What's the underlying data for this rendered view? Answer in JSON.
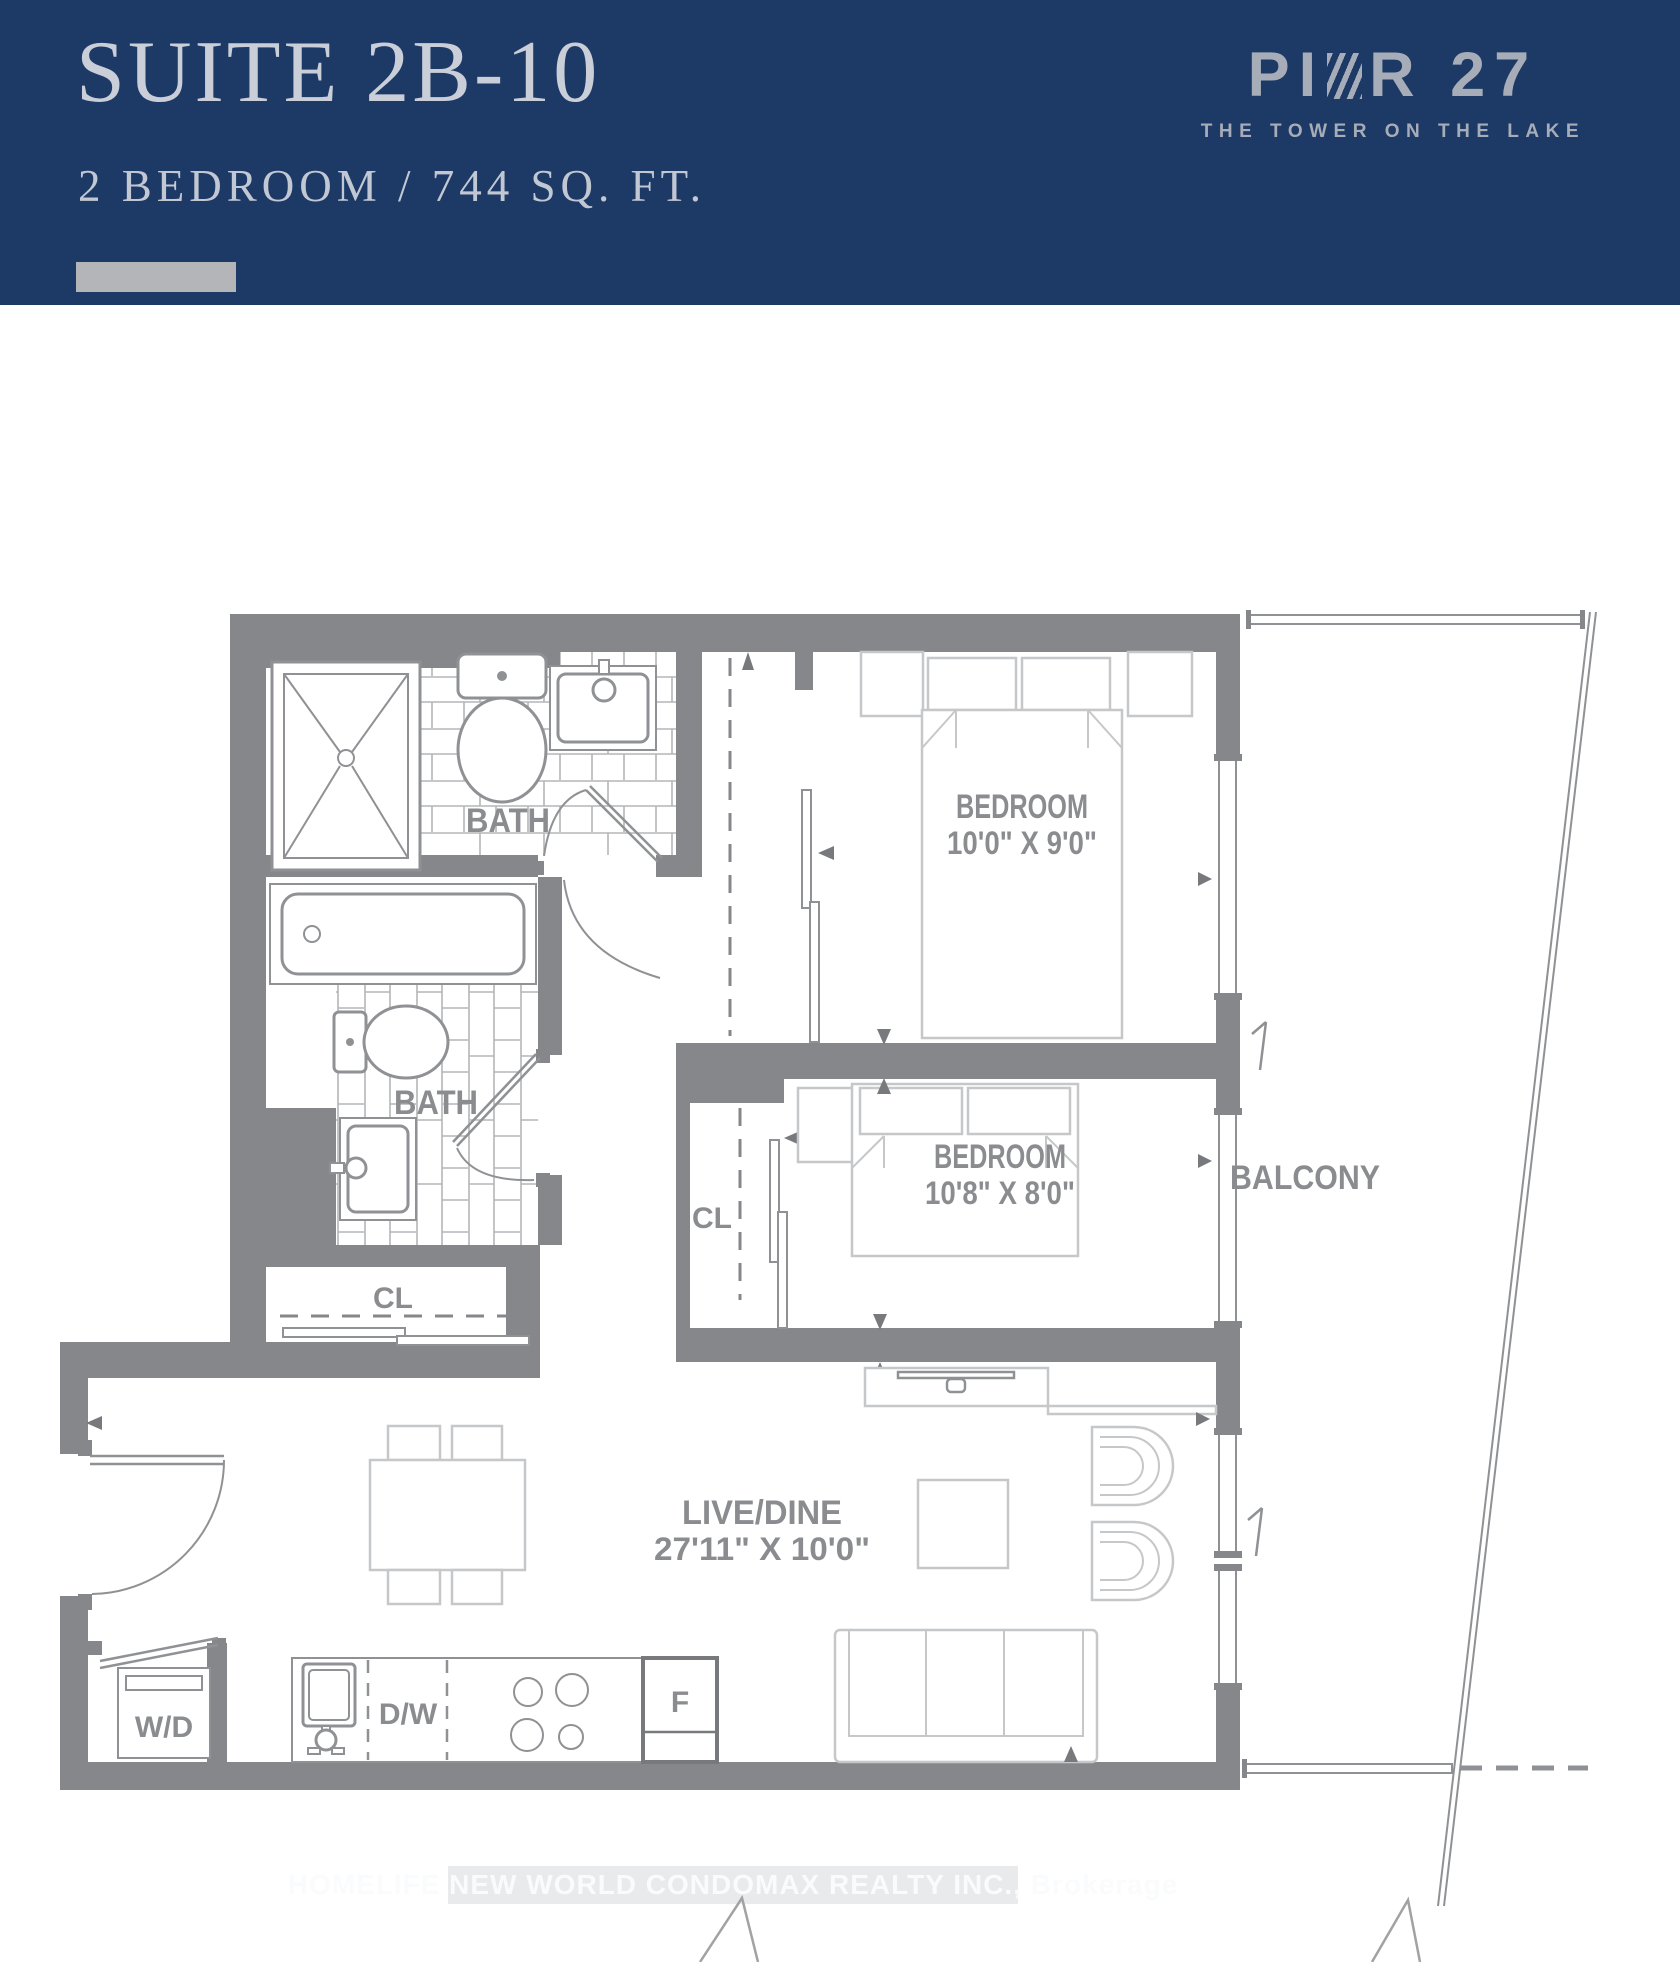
{
  "header": {
    "suite_title": "SUITE 2B-10",
    "suite_subtitle": "2 BEDROOM / 744 SQ. FT.",
    "logo": {
      "name_part1": "PI",
      "name_part2": "R 27",
      "tagline": "THE TOWER ON THE LAKE"
    }
  },
  "plan": {
    "bath1_label": "BATH",
    "bath2_label": "BATH",
    "bedroom1": {
      "name": "BEDROOM",
      "dims": "10'0\" X 9'0\""
    },
    "bedroom2": {
      "name": "BEDROOM",
      "dims": "10'8\" X 8'0\""
    },
    "livedine": {
      "name": "LIVE/DINE",
      "dims": "27'11\" X 10'0\""
    },
    "balcony_label": "BALCONY",
    "closet1_label": "CL",
    "closet2_label": "CL",
    "washer_dryer_label": "W/D",
    "dishwasher_label": "D/W",
    "fridge_label": "F"
  },
  "watermark": "HOMELIFE NEW WORLD CONDOMAX REALTY INC., Brokerage",
  "colors": {
    "header_bg": "#1d3966",
    "header_text": "#c9ced8",
    "logo_text": "#a6adb8",
    "wall": "#85878a",
    "fixture_line": "#8f9194",
    "furniture_line": "#c6c7c9",
    "label_text": "#8a8c8f"
  }
}
